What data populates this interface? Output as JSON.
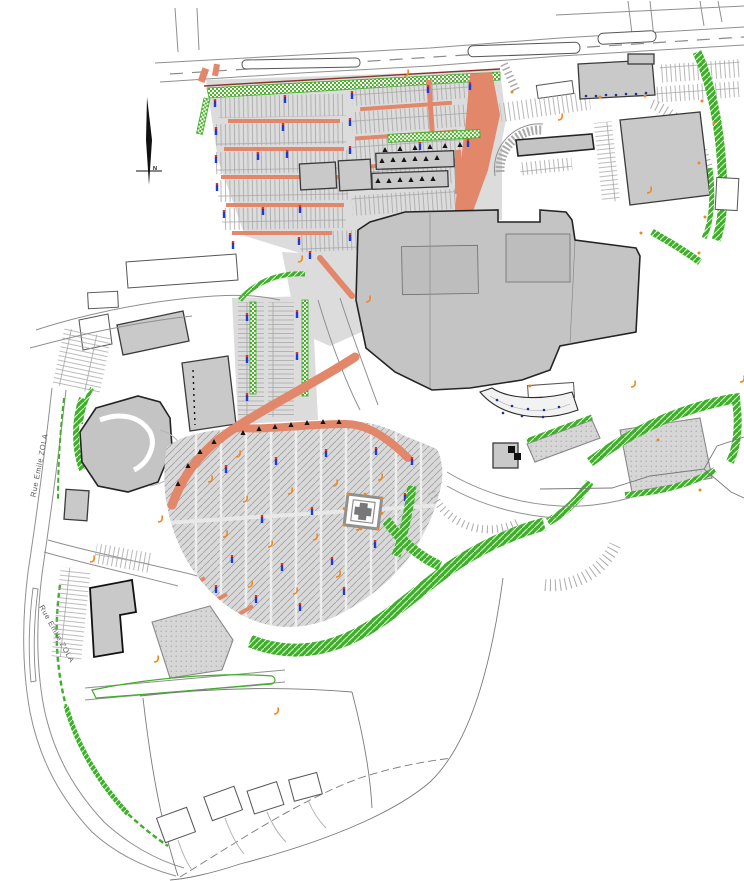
{
  "title": "Shopping centre site plan (CAD masterplan)",
  "labels": {
    "north": "N",
    "road_upper": "Rue Emile ZOLA",
    "road_lower": "Rue Emile ZOLA"
  },
  "colors": {
    "background": "#ffffff",
    "pavement": "#dcdcdc",
    "parking_line": "#a6a6a6",
    "building_fill": "#c9c9c9",
    "building_outline": "#2f2f2f",
    "road_line": "#8f8f8f",
    "landscape_green": "#3fae2a",
    "parking_island_salmon": "#e2876a",
    "kerb_dark_red": "#8a3527",
    "light_pole_blue": "#2038d8",
    "light_pole_red": "#e03020",
    "fixture_orange": "#f08820",
    "tree_black": "#141414",
    "monument_gray": "#787878"
  },
  "symbols": {
    "light_pole": "blue/red parking light pole marker",
    "tree": "black tree marker",
    "fixture": "orange site fixture marker",
    "monument": "square pavilion with cross",
    "landscape_band": "green hatched planting band",
    "landscape_strip": "green checkered planting strip",
    "parking_island": "salmon kerbed island"
  }
}
